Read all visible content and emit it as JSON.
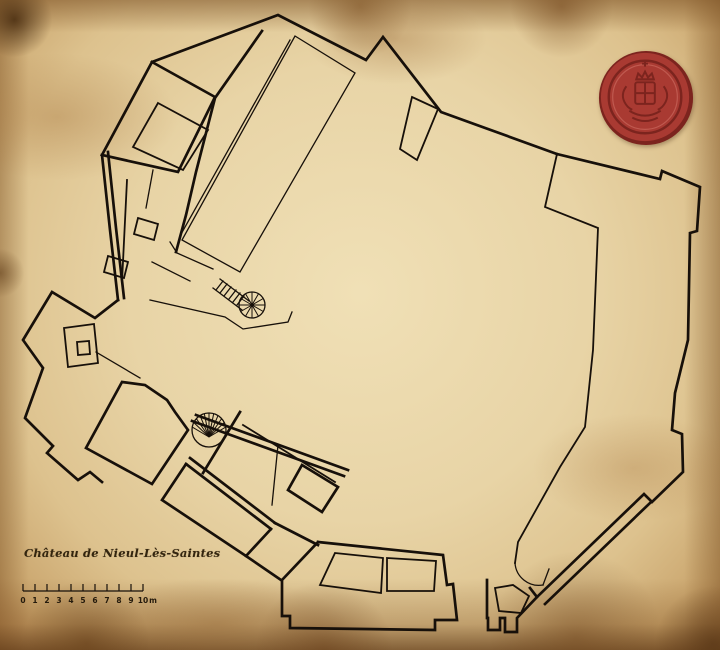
{
  "document": {
    "title": "Château de Nieul-Lès-Saintes",
    "type_note": "hand-drawn castle floor plan on parchment"
  },
  "scale_bar": {
    "x": 23,
    "y": 591,
    "px_per_unit": 12,
    "units": 10,
    "tick_height": 7,
    "labels": [
      "0",
      "1",
      "2",
      "3",
      "4",
      "5",
      "6",
      "7",
      "8",
      "9",
      "10"
    ],
    "unit_label": "m"
  },
  "seal": {
    "name": "red-wax-seal-with-coat-of-arms",
    "colors": {
      "base": "#a93a32",
      "dark": "#7c241e",
      "mid": "#963029",
      "light": "#c05a50"
    }
  },
  "plan": {
    "ink": "#17100a",
    "walls_thick": [
      "M152 62 L278 15 L366 60 L383 37 L441 112 L557 154",
      "M557 154 L660 179 L662 171 L700 187 L697 231 L690 233 L688 340 L675 393 L672 430 L682 434 L683 472 L652 502 L644 494 L537 597",
      "M152 62 L215 97 L178 172 L102 155 Z",
      "M262 31 L215 98 L196 172 L186 215 L176 252",
      "M102 155 L110 230 L118 300",
      "M108 152 L116 228 L124 298",
      "M118 300 L95 318 L52 292 L23 340 L43 368 L25 418 L53 446 L47 453 L78 480 L90 472 L102 482",
      "M122 382 L86 448 L152 484 L188 430 L175 412 L167 400 L145 385 Z",
      "M196 415 L348 470",
      "M192 421 L344 476",
      "M190 458 L275 523",
      "M186 464 L271 529",
      "M240 412 L203 473",
      "M186 464 L162 500 L246 556 L271 529",
      "M246 556 L281 580",
      "M318 542 L443 555 L447 585 L453 584 L457 620 L435 620 L435 630 L290 628 L290 616 L282 616 L282 580 L318 542",
      "M487 580 L487 618 L488 618 L488 630 L500 630 L500 618 L505 618 L505 632 L517 632 L517 618 L537 597 L530 588",
      "M302 465 L338 487 L322 512 L288 490 Z",
      "M275 523 L318 545",
      "M650 503 L545 604"
    ],
    "walls_medium": [
      "M557 154 L545 207 L598 228 L593 350 L585 427 L560 467 L518 542 L515 563",
      "M127 180 L122 282",
      "M138 218 L158 224 L154 240 L134 234 Z",
      "M108 256 L128 262 L124 278 L104 272 Z",
      "M64 328 L94 324 L98 363 L68 367 Z",
      "M77 342 L89 341 L90 354 L78 355 Z",
      "M495 588 L513 585 L529 596 L521 613 L499 611 Z",
      "M335 553 L383 558 L381 593 L320 585 Z",
      "M387 558 L436 561 L434 591 L387 591 Z",
      "M158 103 L208 130 L183 170 L133 147 Z",
      "M412 97 L438 109 L417 160 L400 149 Z",
      "M243 425 L335 482"
    ],
    "lines_thin": [
      "M295 36 L355 73 L240 272 L182 240 Z",
      "M290 40 L180 236",
      "M170 242 L177 253 L213 269",
      "M152 262 L190 281",
      "M150 300 L225 317 L243 329 L288 322 L292 312",
      "M278 445 L272 505",
      "M96 352 L140 378",
      "M153 170 L146 208",
      "M220 279 L249 301",
      "M213 288 L242 310",
      "M223 281 l-7 9",
      "M227 284 l-7 9",
      "M231 287 l-7 9",
      "M236 290 l-7 9",
      "M240 293 l-7 9",
      "M244 296 l-7 9",
      "M515 563 A24 24 0 0 0 543 585",
      "M543 585 L549 569"
    ],
    "spiral_stairs": [
      {
        "name": "spiral-staircase-upper",
        "cx": 252,
        "cy": 305,
        "r": 13,
        "hub_x": 252,
        "hub_y": 305,
        "start_deg": 0,
        "end_deg": 330,
        "step_deg": 30
      },
      {
        "name": "spiral-staircase-lower",
        "cx": 209,
        "cy": 430,
        "r": 17,
        "hub_x": 209,
        "hub_y": 437,
        "start_deg": 190,
        "end_deg": 350,
        "step_deg": 16
      }
    ]
  }
}
